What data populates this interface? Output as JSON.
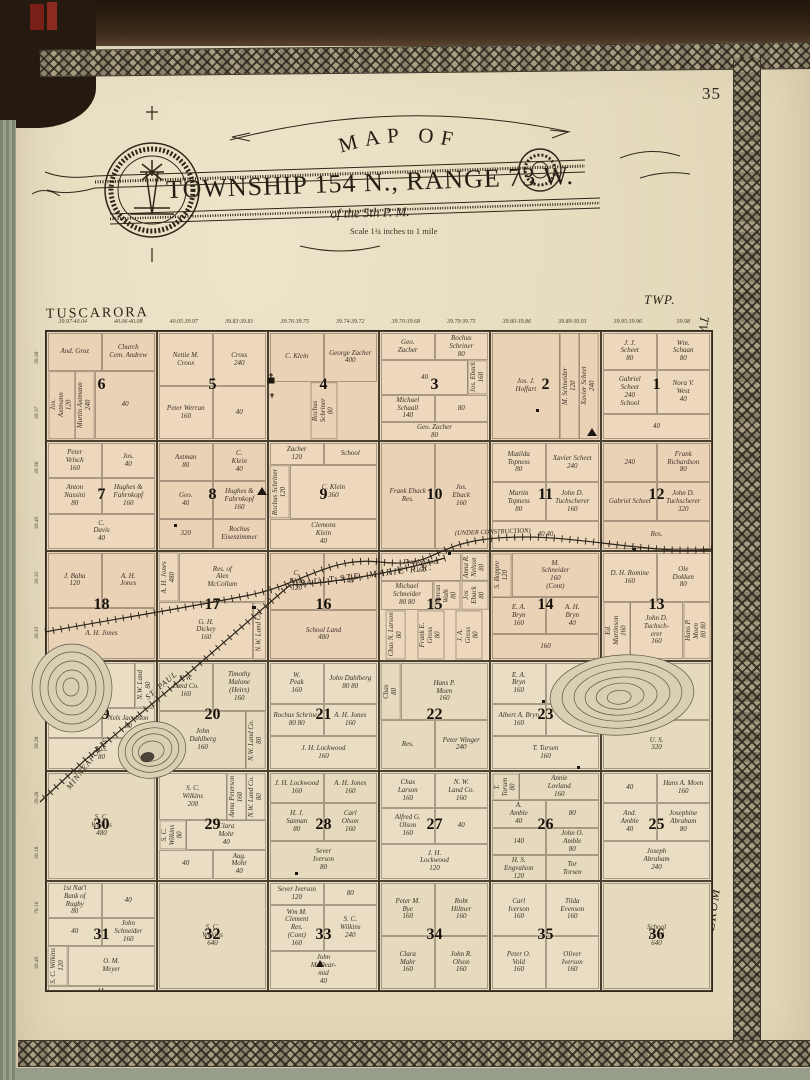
{
  "page": {
    "number": "35"
  },
  "title": {
    "arc": "MAP OF",
    "main": "TOWNSHIP 154 N., RANGE 73 W.",
    "sub": "of the 5th P. M.",
    "scale": "Scale 1¾ inches to 1 mile"
  },
  "edge_labels": {
    "top_left": "TUSCARORA",
    "top_right": "TWP.",
    "right_top": "TWP.",
    "right_bottom": "ELVERUM"
  },
  "railroads": [
    {
      "name": "SAULT STE. MARIE R.R."
    },
    {
      "name": "(UNDER CONSTRUCTION)"
    },
    {
      "name": "ST. PAUL"
    },
    {
      "name": "MINNEAPOLIS"
    }
  ],
  "map_symbols": [
    "church",
    "cemetery",
    "school",
    "residence"
  ],
  "top_numbers": [
    "39.97·40.04",
    "40.06·40.08",
    "40.05·39.97",
    "39.83·39.81",
    "39.76·39.75",
    "39.74·39.72",
    "39.70·39.68",
    "39.79·39.75",
    "39.80·39.86",
    "39.89·39.93",
    "39.95·39.96",
    "39.98"
  ],
  "left_numbers": [
    "39.38",
    "39.37",
    "39.36",
    "39.40",
    "39.35",
    "39.33",
    "39.31",
    "39.28",
    "39.26",
    "39.18",
    "76.16",
    "39.40"
  ],
  "sections": [
    {
      "n": "6",
      "owners": [
        {
          "t": "And. Groz"
        },
        {
          "t": "Church\nCem. Andrew"
        },
        {
          "t": "Jos.\nAxtmann\n120",
          "v": true
        },
        {
          "t": "Martin Axtmann\n240",
          "v": true
        },
        {
          "t": "40"
        }
      ]
    },
    {
      "n": "5",
      "owners": [
        {
          "t": "Nettie M.\nCroox"
        },
        {
          "t": "Cross\n240"
        },
        {
          "t": "Peter Werran\n160"
        },
        {
          "t": "40"
        }
      ]
    },
    {
      "n": "4",
      "owners": [
        {
          "t": "C. Klein"
        },
        {
          "t": "George Zacher\n400"
        },
        {
          "t": "Rochus\nSchriner\n80",
          "v": true
        }
      ]
    },
    {
      "n": "3",
      "owners": [
        {
          "t": "Geo.\nZacher"
        },
        {
          "t": "Rochus\nSchriner\n80"
        },
        {
          "t": "40"
        },
        {
          "t": "Jos. Eback\n160",
          "v": true
        },
        {
          "t": "Michael\nSchaall\n140"
        },
        {
          "t": "80"
        },
        {
          "t": "Geo. Zacher\n80"
        }
      ]
    },
    {
      "n": "2",
      "owners": [
        {
          "t": "Jos. J.\nHoffart"
        },
        {
          "t": "M. Schneider\n120",
          "v": true
        },
        {
          "t": "Xavier Scheet\n240",
          "v": true
        }
      ]
    },
    {
      "n": "1",
      "owners": [
        {
          "t": "J. J.\nScheet\n80"
        },
        {
          "t": "Wm.\nSchaan\n80"
        },
        {
          "t": "Gabriel\nScheet\n240\nSchool"
        },
        {
          "t": "Nora V.\nWest\n40"
        },
        {
          "t": "40"
        }
      ]
    },
    {
      "n": "7",
      "owners": [
        {
          "t": "Peter\nVelsch\n160"
        },
        {
          "t": "Jos.\n40"
        },
        {
          "t": "Anton\nNassini\n80"
        },
        {
          "t": "Hughes &\nFahrnkopf\n160"
        },
        {
          "t": "C.\nDavis\n40"
        }
      ]
    },
    {
      "n": "8",
      "owners": [
        {
          "t": "Axtman\n80"
        },
        {
          "t": "C.\nKlein\n40"
        },
        {
          "t": "Geo.\n40"
        },
        {
          "t": "Hughes &\nFahrnkopf\n160"
        },
        {
          "t": "320"
        },
        {
          "t": "Rochus Eisenzimmer"
        }
      ]
    },
    {
      "n": "9",
      "owners": [
        {
          "t": "Zacher\n120"
        },
        {
          "t": "School"
        },
        {
          "t": "Rochus Schriner\n120",
          "v": true
        },
        {
          "t": "C. Klein\n360"
        },
        {
          "t": "Clemons\nKlein\n40"
        }
      ]
    },
    {
      "n": "10",
      "owners": [
        {
          "t": "Frank Eback\nRes."
        },
        {
          "t": "Jos.\nEback\n160"
        }
      ]
    },
    {
      "n": "11",
      "owners": [
        {
          "t": "Matilda\nTopness\n80"
        },
        {
          "t": "Xavier Scheet\n240"
        },
        {
          "t": "Martin\nTopness\n80"
        },
        {
          "t": "John D. Tuchscherer\n160"
        },
        {
          "t": "40  40"
        }
      ]
    },
    {
      "n": "12",
      "owners": [
        {
          "t": "240"
        },
        {
          "t": "Frank\nRichardson\n80"
        },
        {
          "t": "Gabriel Scheet"
        },
        {
          "t": "John D. Tuchscherer\n320"
        },
        {
          "t": "Res."
        }
      ]
    },
    {
      "n": "18",
      "owners": [
        {
          "t": "J. Baba\n120"
        },
        {
          "t": "A. H.\nJones"
        },
        {
          "t": "A. H. Jones"
        }
      ]
    },
    {
      "n": "17",
      "owners": [
        {
          "t": "A. H. Jones\n480",
          "v": true
        },
        {
          "t": "Res. of\nAlex\nMcCollum"
        },
        {
          "t": "G. H.\nDickey\n160"
        },
        {
          "t": "N.W. Land Co.",
          "v": true
        }
      ]
    },
    {
      "n": "16",
      "owners": [
        {
          "t": "C.\nKlein\n120"
        },
        {
          "t": "40"
        },
        {
          "t": "School Land\n480"
        }
      ]
    },
    {
      "n": "15",
      "owners": [
        {
          "t": "Frank Gross\n160"
        },
        {
          "t": "Anna R.\nNelson\n80",
          "v": true
        },
        {
          "t": "Michael\nSchneider\n80  80"
        },
        {
          "t": "Marcus\nWalk\n80",
          "v": true
        },
        {
          "t": "Jos\nEback\n80",
          "v": true
        },
        {
          "t": "Chas N. Larson\n80",
          "v": true
        },
        {
          "t": "Frank E.\nGross\n80",
          "v": true
        },
        {
          "t": "J. A.\nGross\n80",
          "v": true
        }
      ]
    },
    {
      "n": "14",
      "owners": [
        {
          "t": "S. Boppre\n120",
          "v": true
        },
        {
          "t": "M.\nSchneider\n160\n(Cont)"
        },
        {
          "t": "E. A.\nBryn\n160"
        },
        {
          "t": "A. H.\nBryn\n40"
        },
        {
          "t": "160"
        }
      ]
    },
    {
      "n": "13",
      "owners": [
        {
          "t": "D. H. Romine\n160"
        },
        {
          "t": "Ole\nDokken\n80"
        },
        {
          "t": "Ed.\nMartinson\n160",
          "v": true
        },
        {
          "t": "John D.\nTuchsch-\nerer\n160"
        },
        {
          "t": "Hans P.\nMoen\n80  80",
          "v": true
        }
      ]
    },
    {
      "n": "19",
      "owners": [
        {
          "t": "U.S.\n80"
        },
        {
          "t": "N.W. Land\n80",
          "v": true
        },
        {
          "t": "A. H.\nJones"
        },
        {
          "t": "Nels Jacobson\n80"
        },
        {
          "t": "U.S.\n80"
        }
      ]
    },
    {
      "n": "20",
      "owners": [
        {
          "t": "N.W.\nLand Co.\n160"
        },
        {
          "t": "Timothy\nMalone\n(Heirs)\n160"
        },
        {
          "t": "John\nDahlberg\n160"
        },
        {
          "t": "N.W. Land Co.\n80",
          "v": true
        }
      ]
    },
    {
      "n": "21",
      "owners": [
        {
          "t": "W.\nPeak\n160"
        },
        {
          "t": "John Dahlberg\n80  80"
        },
        {
          "t": "Rochus Schriner\n80  80"
        },
        {
          "t": "A. H. Jones\n160"
        },
        {
          "t": "J. H. Lockwood\n160"
        }
      ]
    },
    {
      "n": "22",
      "owners": [
        {
          "t": "Chas\n80",
          "v": true
        },
        {
          "t": "Hans P.\nMoen\n160"
        },
        {
          "t": "Res."
        },
        {
          "t": "Peter Winger\n240"
        }
      ]
    },
    {
      "n": "23",
      "owners": [
        {
          "t": "E. A.\nBryn\n160"
        },
        {
          "t": "Res."
        },
        {
          "t": "Albert A. Bryn\n160"
        },
        {
          "t": "Res."
        },
        {
          "t": "T. Torsen\n160"
        }
      ]
    },
    {
      "n": "24",
      "owners": [
        {
          "t": "M. A.\nMoen\n160"
        },
        {
          "t": "P. H.\nRomine"
        },
        {
          "t": "U. S.\n320"
        }
      ]
    },
    {
      "n": "30",
      "owners": [
        {
          "t": "S. C.\nWilkins\n480"
        }
      ]
    },
    {
      "n": "29",
      "owners": [
        {
          "t": "S. C.\nWilkins\n200"
        },
        {
          "t": "Anna Peterson\n160",
          "v": true
        },
        {
          "t": "N.W. Land Co.\n80",
          "v": true
        },
        {
          "t": "S. C.\nWilkins\n80",
          "v": true
        },
        {
          "t": "Clara\nMohr\n40"
        },
        {
          "t": "40"
        },
        {
          "t": "Aug.\nMohr\n40"
        }
      ]
    },
    {
      "n": "28",
      "owners": [
        {
          "t": "J. H. Lockwood\n160"
        },
        {
          "t": "A. H. Jones\n160"
        },
        {
          "t": "H. J.\nSannan\n80"
        },
        {
          "t": "Carl\nOlson\n160"
        },
        {
          "t": "Sever\nIverson\n80"
        }
      ]
    },
    {
      "n": "27",
      "owners": [
        {
          "t": "Chas\nLarson\n160"
        },
        {
          "t": "N. W.\nLand Co.\n160"
        },
        {
          "t": "Alfred G.\nOlson\n160"
        },
        {
          "t": "40"
        },
        {
          "t": "J. H.\nLockwood\n120"
        }
      ]
    },
    {
      "n": "26",
      "owners": [
        {
          "t": "T.\nTorsen\n80",
          "v": true
        },
        {
          "t": "Annie\nLovland\n160"
        },
        {
          "t": "A.\nAmble\n40"
        },
        {
          "t": "80"
        },
        {
          "t": "140"
        },
        {
          "t": "John O.\nAmble\n80"
        },
        {
          "t": "H. S.\nEngvalson\n120"
        },
        {
          "t": "Tor\nTorsen"
        }
      ]
    },
    {
      "n": "25",
      "owners": [
        {
          "t": "40"
        },
        {
          "t": "Hans A. Moen\n160"
        },
        {
          "t": "And.\nAmble\n40"
        },
        {
          "t": "Josephine\nAbraham\n80"
        },
        {
          "t": "Joseph\nAbraham\n240"
        }
      ]
    },
    {
      "n": "31",
      "owners": [
        {
          "t": "1st Nat'l\nBank of\nRugby\n80"
        },
        {
          "t": "40"
        },
        {
          "t": "40"
        },
        {
          "t": "John\nSchneider\n160"
        },
        {
          "t": "S. C. Wilkins\n120",
          "v": true
        },
        {
          "t": "O. M.\nMeyer"
        },
        {
          "t": "M.\nGoetz\n40"
        }
      ]
    },
    {
      "n": "32",
      "owners": [
        {
          "t": "S. C.\nWilkins\n640"
        }
      ]
    },
    {
      "n": "33",
      "owners": [
        {
          "t": "Sever Iverson\n120"
        },
        {
          "t": "80"
        },
        {
          "t": "Wm M.\nClement\nRes.\n(Cont)\n160"
        },
        {
          "t": "S. C.\nWilkins\n240"
        },
        {
          "t": "John\nMcDear-\nmid\n40"
        }
      ]
    },
    {
      "n": "34",
      "owners": [
        {
          "t": "Peter M.\nBye\n160"
        },
        {
          "t": "Robt\nHiltner\n160"
        },
        {
          "t": "Clara\nMahr\n160"
        },
        {
          "t": "John R.\nOlson\n160"
        }
      ]
    },
    {
      "n": "35",
      "owners": [
        {
          "t": "Carl\nIverson\n160"
        },
        {
          "t": "Tilda\nEvenson\n160"
        },
        {
          "t": "Peter O.\nVold\n160"
        },
        {
          "t": "Oliver\nIverson\n160"
        }
      ]
    },
    {
      "n": "36",
      "owners": [
        {
          "t": "School\nLand\n640"
        }
      ]
    }
  ]
}
